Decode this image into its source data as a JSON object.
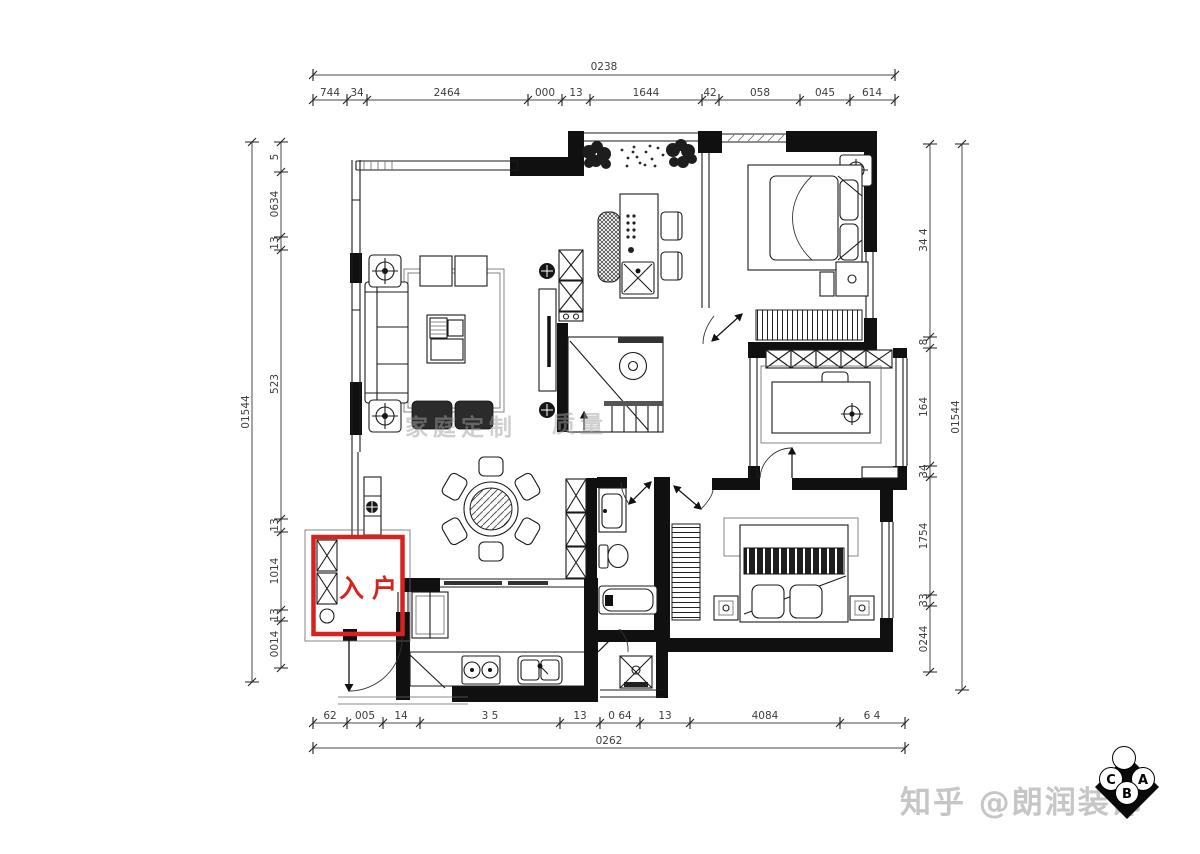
{
  "dims": {
    "top": {
      "total": "0238",
      "segments": [
        "744",
        "34",
        "2464",
        "000",
        "13",
        "1644",
        "42",
        "058",
        "045",
        "614"
      ]
    },
    "bottom": {
      "total": "0262",
      "segments": [
        "62",
        "005",
        "14",
        "3 5",
        "13",
        "0 64",
        "13",
        "4084",
        "6 4"
      ]
    },
    "left": {
      "total": "01544",
      "segments": [
        "5",
        "0634",
        "13",
        "523",
        "13",
        "1014",
        "13",
        "0014"
      ]
    },
    "right": {
      "total": "01544",
      "segments": [
        "34 4",
        "8",
        "164",
        "34",
        "1754",
        "33",
        "0244"
      ]
    }
  },
  "plan": {
    "entrance_label": "入户",
    "highlight_color": "#d7231d",
    "center_watermarks": [
      "家庭定制",
      "质量"
    ]
  },
  "branding": {
    "watermark": "知乎 @朗润装饰",
    "logo_letters": {
      "left": "C",
      "right": "A",
      "bottom": "B"
    }
  }
}
